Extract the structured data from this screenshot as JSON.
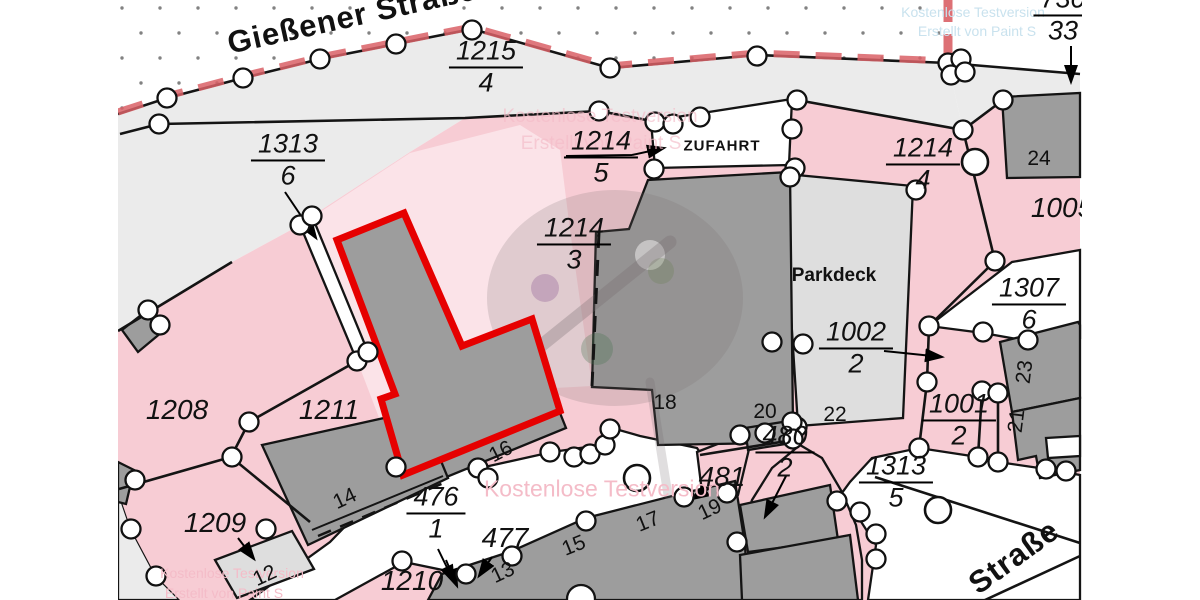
{
  "map": {
    "streets": {
      "giessener": "Gießener Straße",
      "strasse": "Straße"
    },
    "signs": {
      "zufahrt": "ZUFAHRT",
      "parkdeck": "Parkdeck"
    },
    "fraction_labels": {
      "p1215_4": {
        "num": "1215",
        "den": "4"
      },
      "p1313_6": {
        "num": "1313",
        "den": "6"
      },
      "p1214_5": {
        "num": "1214",
        "den": "5"
      },
      "p1214_3": {
        "num": "1214",
        "den": "3"
      },
      "p1214_4": {
        "num": "1214",
        "den": "4"
      },
      "p1307_6": {
        "num": "1307",
        "den": "6"
      },
      "p1002_2": {
        "num": "1002",
        "den": "2"
      },
      "p1001_2": {
        "num": "1001",
        "den": "2"
      },
      "p1313_5": {
        "num": "1313",
        "den": "5"
      },
      "p476_1": {
        "num": "476",
        "den": "1"
      },
      "p480_2": {
        "num": "480",
        "den": "2"
      },
      "p730_33": {
        "num": "730",
        "den": "33"
      }
    },
    "single_labels": {
      "p1208": "1208",
      "p1211": "1211",
      "p1209": "1209",
      "p1210": "1210",
      "p477": "477",
      "p481": "481",
      "p1005": "1005"
    },
    "building_numbers": {
      "b24": "24",
      "b18": "18",
      "b20": "20",
      "b22": "22",
      "b16": "16",
      "b14": "14",
      "b12": "12",
      "b13": "13",
      "b15": "15",
      "b17": "17",
      "b19": "19",
      "b21": "21",
      "b23": "23"
    },
    "watermarks": {
      "trial": "Kostenlose Testversion",
      "creator": "Erstellt von Paint S"
    },
    "colors": {
      "parcel_pink": "#f7ccd4",
      "parcel_pink_light": "#fbe3e8",
      "street_grey": "#ebebeb",
      "building_grey": "#9d9d9d",
      "building_light": "#dedede",
      "outline": "#141414",
      "selection_red": "#e60000",
      "boundary_red": "#d96066",
      "watermark_pink": "#f4bcc8",
      "watermark_blue": "#c9e2ee"
    }
  }
}
